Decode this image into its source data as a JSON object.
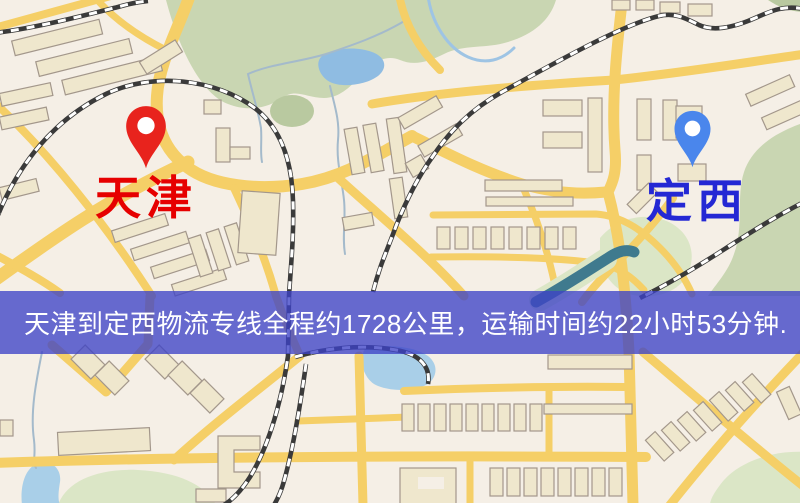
{
  "map": {
    "origin": {
      "label": "天津",
      "marker": "red-map-pin"
    },
    "destination": {
      "label": "定西",
      "marker": "blue-map-pin"
    }
  },
  "banner": {
    "text": "天津到定西物流专线全程约1728公里，运输时间约22小时53分钟.",
    "route": {
      "origin": "天津",
      "destination": "定西",
      "distance_km": 1728,
      "duration": "22小时53分钟"
    }
  },
  "colors": {
    "map_bg": "#f5efe6",
    "road": "#f5cf67",
    "park": "#c9d6b2",
    "park_light": "#dbe6c6",
    "park_dark": "#b9c9a0",
    "water": "#8fbce2",
    "water_light": "#a9cfe8",
    "river_teal": "#3f7a8e",
    "building": "#efe7cd",
    "building_line": "#a3978b",
    "railway": "#3a3a3a",
    "pin_red": "#e8231d",
    "pin_blue": "#4a86ec",
    "label_red": "#e60000",
    "label_blue": "#2428d4",
    "banner_bg": "rgba(62,66,198,0.78)",
    "banner_text": "#ffffff"
  }
}
